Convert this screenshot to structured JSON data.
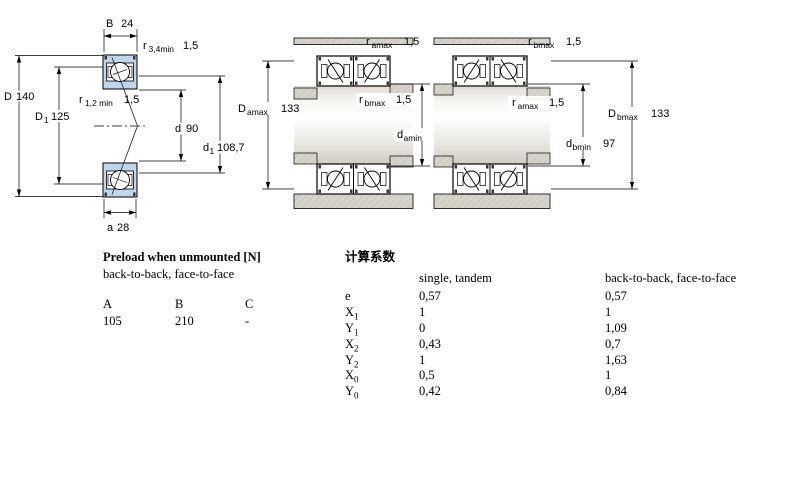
{
  "page": {
    "background": "#ffffff"
  },
  "colors": {
    "bearing_fill": "#bed3ec",
    "housing_fill": "#d6d3cb",
    "line": "#000000"
  },
  "diagrams": {
    "left": {
      "name": "single bearing cross-section",
      "labels": {
        "B": {
          "sym": "B",
          "value": "24"
        },
        "r34": {
          "sym": "r",
          "sub": "3,4min",
          "value": "1,5"
        },
        "D": {
          "sym": "D",
          "value": "140"
        },
        "D1": {
          "sym": "D",
          "sub": "1",
          "value": "125"
        },
        "r12": {
          "sym": "r",
          "sub": "1,2 min",
          "value": "1,5"
        },
        "d": {
          "sym": "d",
          "value": "90"
        },
        "d1": {
          "sym": "d",
          "sub": "1",
          "value": "108,7"
        },
        "a": {
          "sym": "a",
          "value": "28"
        }
      }
    },
    "middle": {
      "name": "arrangement a mounting dimensions",
      "labels": {
        "ramax": {
          "sym": "r",
          "sub": "amax",
          "value": "1,5"
        },
        "Damax": {
          "sym": "D",
          "sub": "amax",
          "value": "133"
        },
        "rbmax": {
          "sym": "r",
          "sub": "bmax",
          "value": "1,5"
        },
        "damin": {
          "sym": "d",
          "sub": "amin",
          "value": "97"
        }
      }
    },
    "right": {
      "name": "arrangement b mounting dimensions",
      "labels": {
        "rbmax": {
          "sym": "r",
          "sub": "bmax",
          "value": "1,5"
        },
        "ramax": {
          "sym": "r",
          "sub": "amax",
          "value": "1,5"
        },
        "Dbmax": {
          "sym": "D",
          "sub": "bmax",
          "value": "133"
        },
        "dbmin": {
          "sym": "d",
          "sub": "bmin",
          "value": "97"
        }
      }
    }
  },
  "preload_table": {
    "title": "Preload when unmounted [N]",
    "subtitle": "back-to-back, face-to-face",
    "columns": [
      "A",
      "B",
      "C"
    ],
    "values": [
      "105",
      "210",
      "-"
    ]
  },
  "factors_table": {
    "title": "计算系数",
    "col_single": "single, tandem",
    "col_paired": "back-to-back, face-to-face",
    "rows": [
      {
        "base": "e",
        "sub": "",
        "single": "0,57",
        "paired": "0,57"
      },
      {
        "base": "X",
        "sub": "1",
        "single": "1",
        "paired": "1"
      },
      {
        "base": "Y",
        "sub": "1",
        "single": "0",
        "paired": "1,09"
      },
      {
        "base": "X",
        "sub": "2",
        "single": "0,43",
        "paired": "0,7"
      },
      {
        "base": "Y",
        "sub": "2",
        "single": "1",
        "paired": "1,63"
      },
      {
        "base": "X",
        "sub": "0",
        "single": "0,5",
        "paired": "1"
      },
      {
        "base": "Y",
        "sub": "0",
        "single": "0,42",
        "paired": "0,84"
      }
    ]
  }
}
